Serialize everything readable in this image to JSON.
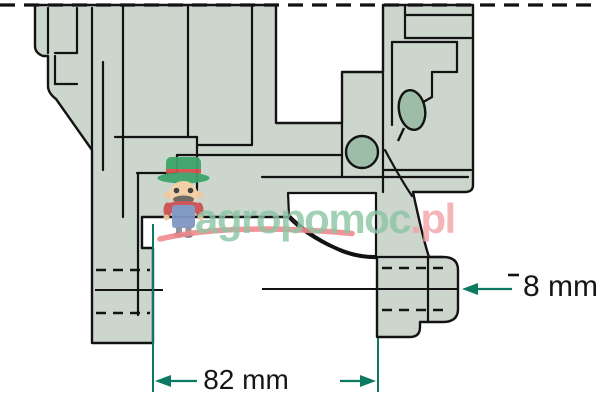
{
  "diagram": {
    "type": "technical cross-section drawing",
    "subject": "machine part mounting flange cross-section",
    "dimensions": {
      "width_label": "82 mm",
      "boss_label": "8 mm"
    },
    "colors": {
      "body_fill": "#ccd6cd",
      "detail_fill": "#9dbda8",
      "outline": "#131313",
      "dimension_accent": "#0c7a62",
      "watermark_green": "#8cc5a3",
      "watermark_pink": "#f2a2a7",
      "swoosh_red": "#ef8a8e"
    },
    "icons": {
      "mascot": "farmer-mascot-icon"
    }
  },
  "watermark": {
    "brand_main": "agropomoc",
    "brand_tld": ".pl"
  }
}
